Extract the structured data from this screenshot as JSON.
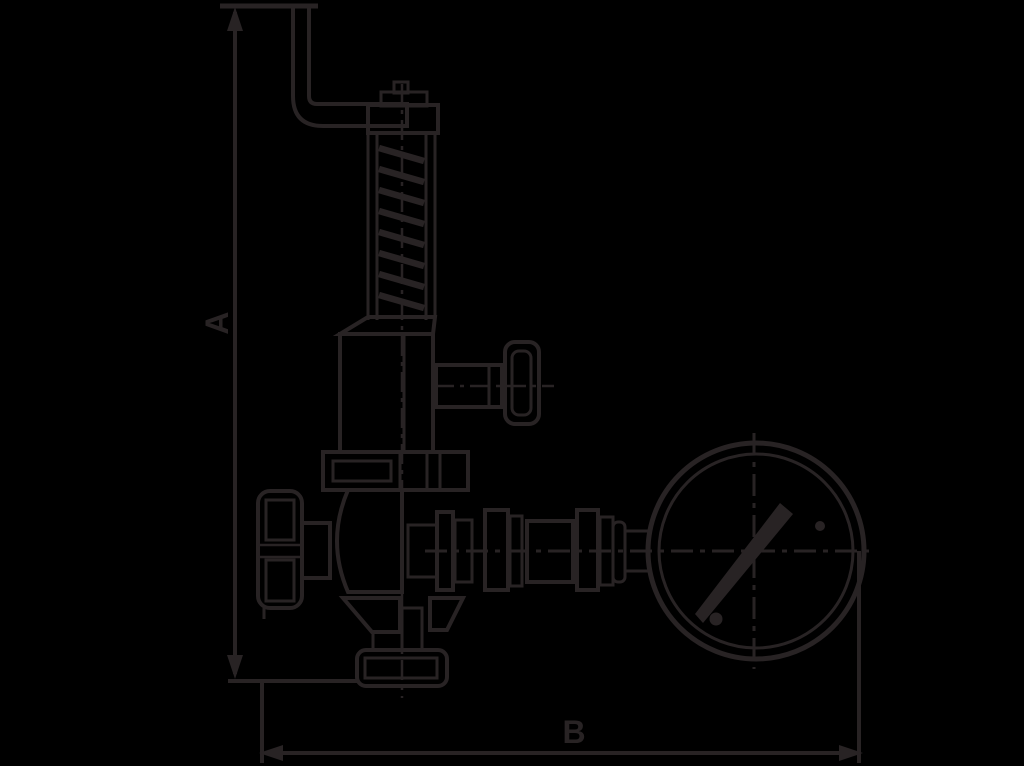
{
  "canvas": {
    "background_color": "#000000",
    "ink_color": "#282324"
  },
  "diagram": {
    "type": "technical-line-drawing",
    "subject": "Safety relief valve with top lever, spring bonnet, side outlet cap, shut-off handwheel, bottom outlet flange and pressure gauge",
    "dimension_labels": {
      "vertical": "A",
      "horizontal": "B"
    },
    "components": [
      "lever-handle",
      "adjusting-cap",
      "spring-column",
      "bonnet",
      "side-outlet",
      "union-nut",
      "valve-body",
      "handwheel",
      "bottom-outlet-flange",
      "gauge-piping",
      "pressure-gauge"
    ]
  }
}
